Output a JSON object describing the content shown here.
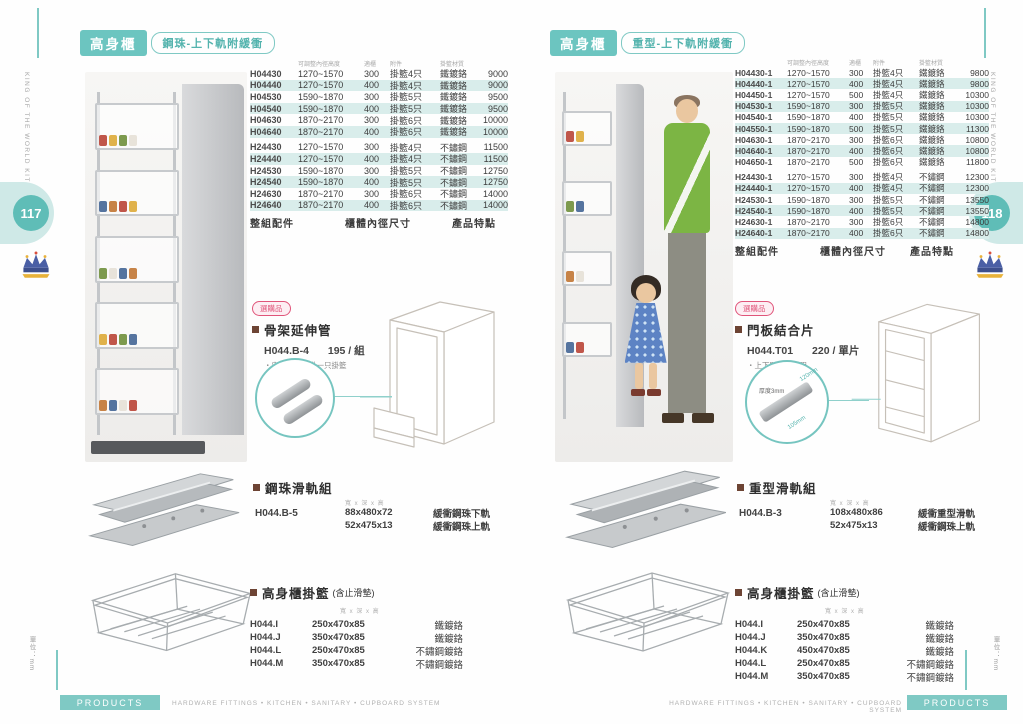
{
  "shared": {
    "brand_line1": "KING OF THE WORLD",
    "brand_line2": "KITCHEN WARES",
    "unit": "單位：mm",
    "footer": {
      "products": "PRODUCTS",
      "tagline": "HARDWARE FITTINGS • KITCHEN • SANITARY • CUPBOARD SYSTEM"
    },
    "colors": {
      "accent": "#7fc9c4",
      "row_alt": "#d9edeb",
      "badge_red": "#e0557a",
      "bullet": "#6d4434",
      "page_circle": "#5fbdb7"
    }
  },
  "page_left": {
    "page_number": "117",
    "header": {
      "title": "高身櫃",
      "subtitle": "鋼珠-上下軌附緩衝"
    },
    "table": {
      "headers": [
        "可調整內徑高度",
        "適櫃",
        "附件",
        "掛籃材質"
      ],
      "group1": [
        {
          "model": "H04430",
          "range": "1270~1570",
          "width": "300",
          "acc": "掛籃4只",
          "mat": "鐵鍍鉻",
          "price": "9000"
        },
        {
          "model": "H04440",
          "range": "1270~1570",
          "width": "400",
          "acc": "掛籃4只",
          "mat": "鐵鍍鉻",
          "price": "9000"
        },
        {
          "model": "H04530",
          "range": "1590~1870",
          "width": "300",
          "acc": "掛籃5只",
          "mat": "鐵鍍鉻",
          "price": "9500"
        },
        {
          "model": "H04540",
          "range": "1590~1870",
          "width": "400",
          "acc": "掛籃5只",
          "mat": "鐵鍍鉻",
          "price": "9500"
        },
        {
          "model": "H04630",
          "range": "1870~2170",
          "width": "300",
          "acc": "掛籃6只",
          "mat": "鐵鍍鉻",
          "price": "10000"
        },
        {
          "model": "H04640",
          "range": "1870~2170",
          "width": "400",
          "acc": "掛籃6只",
          "mat": "鐵鍍鉻",
          "price": "10000"
        }
      ],
      "group2": [
        {
          "model": "H24430",
          "range": "1270~1570",
          "width": "300",
          "acc": "掛籃4只",
          "mat": "不鏽鋼",
          "price": "11500"
        },
        {
          "model": "H24440",
          "range": "1270~1570",
          "width": "400",
          "acc": "掛籃4只",
          "mat": "不鏽鋼",
          "price": "11500"
        },
        {
          "model": "H24530",
          "range": "1590~1870",
          "width": "300",
          "acc": "掛籃5只",
          "mat": "不鏽鋼",
          "price": "12750"
        },
        {
          "model": "H24540",
          "range": "1590~1870",
          "width": "400",
          "acc": "掛籃5只",
          "mat": "不鏽鋼",
          "price": "12750"
        },
        {
          "model": "H24630",
          "range": "1870~2170",
          "width": "300",
          "acc": "掛籃6只",
          "mat": "不鏽鋼",
          "price": "14000"
        },
        {
          "model": "H24640",
          "range": "1870~2170",
          "width": "400",
          "acc": "掛籃6只",
          "mat": "不鏽鋼",
          "price": "14000"
        }
      ]
    },
    "spec": {
      "acc_title": "整組配件",
      "acc_items": [
        "・框架組(銀色烤漆)x1組",
        "・鋼珠滑軌(銀色烤漆)x1組",
        "・緩衝上滑軌x1組",
        "・高身櫃掛籃",
        "・掛籃止滑墊"
      ],
      "size_title": "櫃體內徑尺寸",
      "size_items": [
        "・W : Min. 260 / 360",
        "・D : Min. 510",
        "・H : 1270~1570",
        "        : 1590~1870",
        "        : 1870~2170"
      ],
      "feat_title": "產品特點",
      "feat_items": [
        "・載重60kg"
      ]
    },
    "optional": {
      "badge": "選購品",
      "title": "骨架延伸管",
      "model": "H044.B-4",
      "price": "195 / 組",
      "note": "・安裝後可加掛一只掛籃"
    },
    "rail": {
      "title": "鋼珠滑軌組",
      "dims_header": "寬 x 深 x 高",
      "model": "H044.B-5",
      "rows": [
        {
          "dims": "88x480x72",
          "desc": "緩衝鋼珠下軌"
        },
        {
          "dims": "52x475x13",
          "desc": "緩衝鋼珠上軌"
        }
      ]
    },
    "baskets": {
      "title": "高身櫃掛籃",
      "note": "(含止滑墊)",
      "dims_header": "寬 x 深 x 高",
      "rows": [
        {
          "model": "H044.I",
          "dims": "250x470x85",
          "mat": "鐵鍍鉻"
        },
        {
          "model": "H044.J",
          "dims": "350x470x85",
          "mat": "鐵鍍鉻"
        },
        {
          "model": "H044.L",
          "dims": "250x470x85",
          "mat": "不鏽鋼鍍鉻"
        },
        {
          "model": "H044.M",
          "dims": "350x470x85",
          "mat": "不鏽鋼鍍鉻"
        }
      ]
    }
  },
  "page_right": {
    "page_number": "118",
    "header": {
      "title": "高身櫃",
      "subtitle": "重型-上下軌附緩衝"
    },
    "table": {
      "headers": [
        "可調整內徑高度",
        "適櫃",
        "附件",
        "掛籃材質"
      ],
      "group1": [
        {
          "model": "H04430-1",
          "range": "1270~1570",
          "width": "300",
          "acc": "掛籃4只",
          "mat": "鐵鍍鉻",
          "price": "9800"
        },
        {
          "model": "H04440-1",
          "range": "1270~1570",
          "width": "400",
          "acc": "掛籃4只",
          "mat": "鐵鍍鉻",
          "price": "9800"
        },
        {
          "model": "H04450-1",
          "range": "1270~1570",
          "width": "500",
          "acc": "掛籃4只",
          "mat": "鐵鍍鉻",
          "price": "10300"
        },
        {
          "model": "H04530-1",
          "range": "1590~1870",
          "width": "300",
          "acc": "掛籃5只",
          "mat": "鐵鍍鉻",
          "price": "10300"
        },
        {
          "model": "H04540-1",
          "range": "1590~1870",
          "width": "400",
          "acc": "掛籃5只",
          "mat": "鐵鍍鉻",
          "price": "10300"
        },
        {
          "model": "H04550-1",
          "range": "1590~1870",
          "width": "500",
          "acc": "掛籃5只",
          "mat": "鐵鍍鉻",
          "price": "11300"
        },
        {
          "model": "H04630-1",
          "range": "1870~2170",
          "width": "300",
          "acc": "掛籃6只",
          "mat": "鐵鍍鉻",
          "price": "10800"
        },
        {
          "model": "H04640-1",
          "range": "1870~2170",
          "width": "400",
          "acc": "掛籃6只",
          "mat": "鐵鍍鉻",
          "price": "10800"
        },
        {
          "model": "H04650-1",
          "range": "1870~2170",
          "width": "500",
          "acc": "掛籃6只",
          "mat": "鐵鍍鉻",
          "price": "11800"
        }
      ],
      "group2": [
        {
          "model": "H24430-1",
          "range": "1270~1570",
          "width": "300",
          "acc": "掛籃4只",
          "mat": "不鏽鋼",
          "price": "12300"
        },
        {
          "model": "H24440-1",
          "range": "1270~1570",
          "width": "400",
          "acc": "掛籃4只",
          "mat": "不鏽鋼",
          "price": "12300"
        },
        {
          "model": "H24530-1",
          "range": "1590~1870",
          "width": "300",
          "acc": "掛籃5只",
          "mat": "不鏽鋼",
          "price": "13550"
        },
        {
          "model": "H24540-1",
          "range": "1590~1870",
          "width": "400",
          "acc": "掛籃5只",
          "mat": "不鏽鋼",
          "price": "13550"
        },
        {
          "model": "H24630-1",
          "range": "1870~2170",
          "width": "300",
          "acc": "掛籃6只",
          "mat": "不鏽鋼",
          "price": "14800"
        },
        {
          "model": "H24640-1",
          "range": "1870~2170",
          "width": "400",
          "acc": "掛籃6只",
          "mat": "不鏽鋼",
          "price": "14800"
        }
      ]
    },
    "spec": {
      "acc_title": "整組配件",
      "acc_items": [
        "・框架組(銀色烤漆)x1組",
        "・重型滑軌(銀色烤漆)x1組",
        "・緩衝上滑軌x1組",
        "・高身櫃掛籃",
        "・掛籃止滑墊"
      ],
      "size_title": "櫃體內徑尺寸",
      "size_items": [
        "・W : Min. 260 / 360 / 460",
        "・D : Min. 510",
        "・H : 1270~1570",
        "        : 1590~1870",
        "        : 1870~2170"
      ],
      "feat_title": "產品特點",
      "feat_items": [
        "・載重80kg"
      ]
    },
    "optional": {
      "badge": "選購品",
      "title": "門板結合片",
      "model": "H044.T01",
      "price": "220 / 單片",
      "note": "・上下門板連結用"
    },
    "inset_labels": {
      "thickness": "厚度3mm",
      "dim1": "120mm",
      "dim2": "105mm"
    },
    "rail": {
      "title": "重型滑軌組",
      "dims_header": "寬 x 深 x 高",
      "model": "H044.B-3",
      "rows": [
        {
          "dims": "108x480x86",
          "desc": "緩衝重型滑軌"
        },
        {
          "dims": "52x475x13",
          "desc": "緩衝鋼珠上軌"
        }
      ]
    },
    "baskets": {
      "title": "高身櫃掛籃",
      "note": "(含止滑墊)",
      "dims_header": "寬 x 深 x 高",
      "rows": [
        {
          "model": "H044.I",
          "dims": "250x470x85",
          "mat": "鐵鍍鉻"
        },
        {
          "model": "H044.J",
          "dims": "350x470x85",
          "mat": "鐵鍍鉻"
        },
        {
          "model": "H044.K",
          "dims": "450x470x85",
          "mat": "鐵鍍鉻"
        },
        {
          "model": "H044.L",
          "dims": "250x470x85",
          "mat": "不鏽鋼鍍鉻"
        },
        {
          "model": "H044.M",
          "dims": "350x470x85",
          "mat": "不鏽鋼鍍鉻"
        }
      ]
    }
  }
}
